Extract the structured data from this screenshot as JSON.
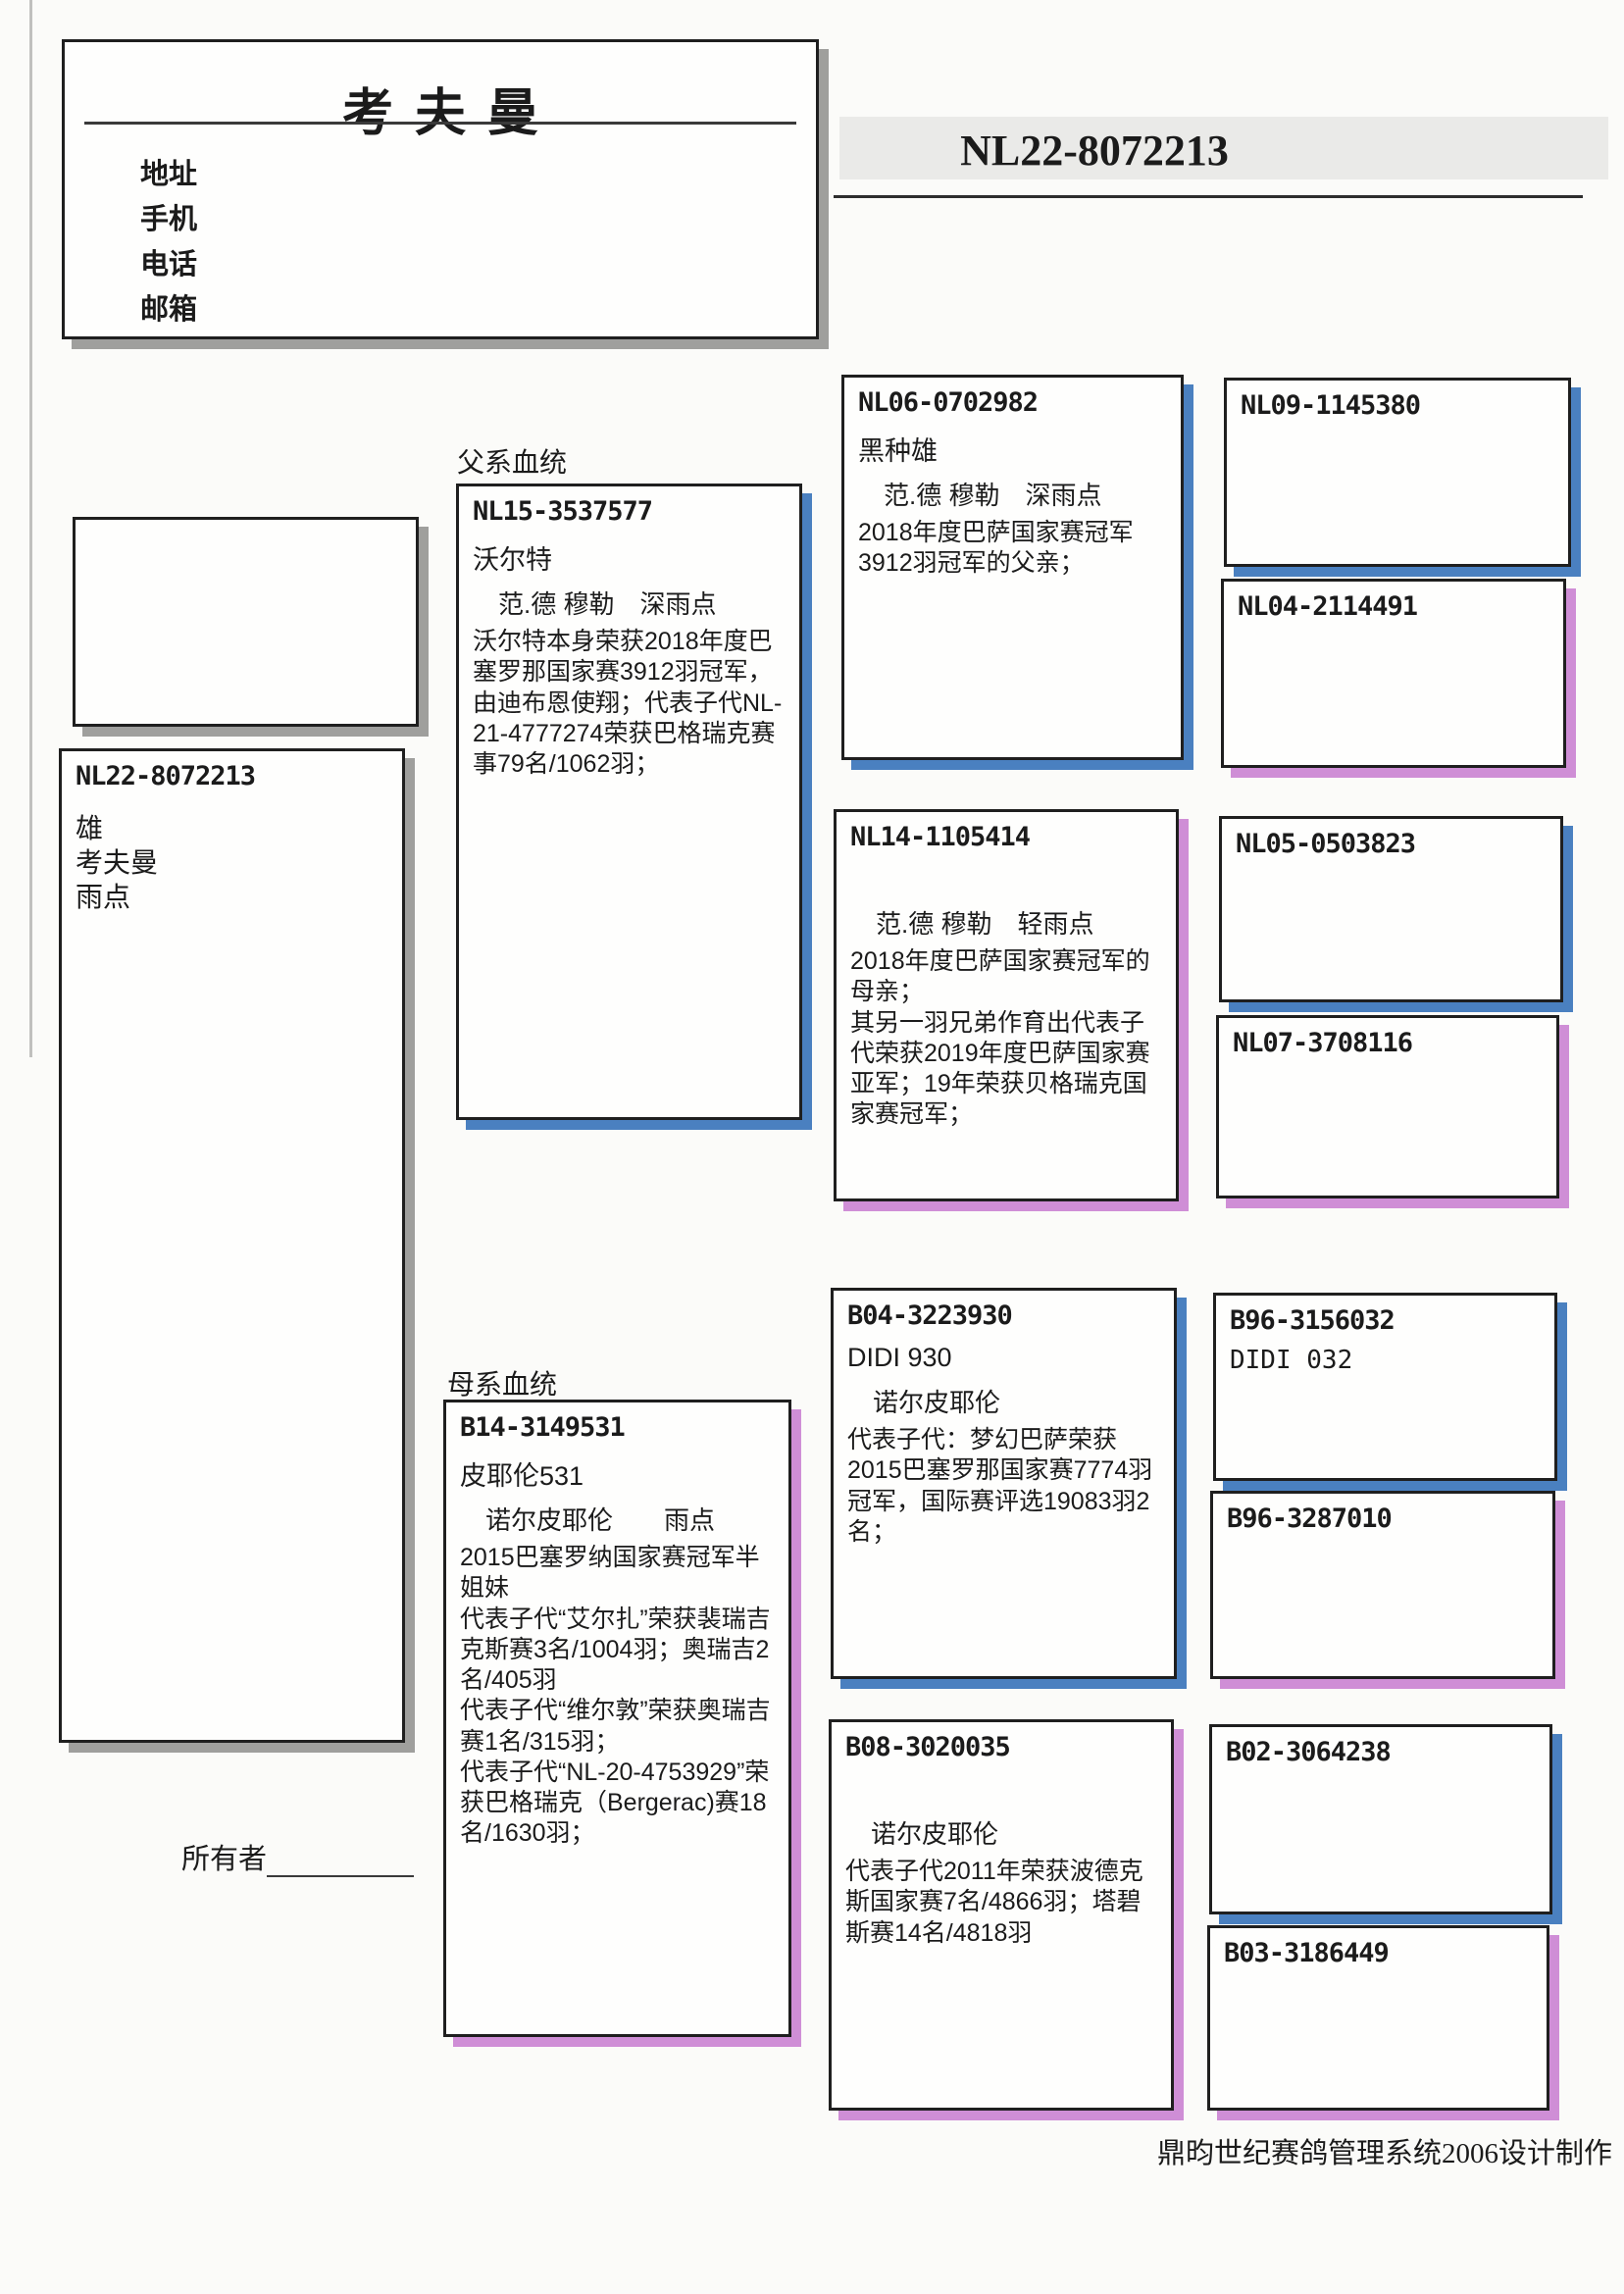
{
  "loft": {
    "title": "考夫曼",
    "labels": [
      "地址",
      "手机",
      "电话",
      "邮箱"
    ]
  },
  "header": {
    "ring": "NL22-8072213"
  },
  "sections": {
    "paternal": "父系血统",
    "maternal": "母系血统"
  },
  "subject": {
    "ring": "NL22-8072213",
    "sex": "雄",
    "strain": "考夫曼",
    "color": "雨点"
  },
  "father": {
    "ring": "NL15-3537577",
    "name": "沃尔特",
    "strain": "范.德 穆勒　深雨点",
    "desc": "沃尔特本身荣获2018年度巴塞罗那国家赛3912羽冠军，由迪布恩使翔；代表子代NL-21-4777274荣获巴格瑞克赛事79名/1062羽；"
  },
  "mother": {
    "ring": "B14-3149531",
    "name": "皮耶伦531",
    "strain": "诺尔皮耶伦　　雨点",
    "desc": "2015巴塞罗纳国家赛冠军半姐妹\n代表子代“艾尔扎”荣获裴瑞吉克斯赛3名/1004羽；奥瑞吉2名/405羽\n代表子代“维尔敦”荣获奥瑞吉赛1名/315羽；\n代表子代“NL-20-4753929”荣获巴格瑞克（Bergerac)赛18名/1630羽；"
  },
  "ff": {
    "ring": "NL06-0702982",
    "name": "黑种雄",
    "strain": "范.德 穆勒　深雨点",
    "desc": "2018年度巴萨国家赛冠军3912羽冠军的父亲；"
  },
  "fm": {
    "ring": "NL14-1105414",
    "name": "",
    "strain": "范.德 穆勒　轻雨点",
    "desc": "2018年度巴萨国家赛冠军的母亲；\n其另一羽兄弟作育出代表子代荣获2019年度巴萨国家赛亚军；19年荣获贝格瑞克国家赛冠军；"
  },
  "mf": {
    "ring": "B04-3223930",
    "name": "DIDI 930",
    "strain": "诺尔皮耶伦",
    "desc": "代表子代：梦幻巴萨荣获2015巴塞罗那国家赛7774羽冠军，国际赛评选19083羽2名；"
  },
  "mm": {
    "ring": "B08-3020035",
    "name": "",
    "strain": "诺尔皮耶伦",
    "desc": "代表子代2011年荣获波德克斯国家赛7名/4866羽；塔碧斯赛14名/4818羽"
  },
  "gg": [
    {
      "ring": "NL09-1145380",
      "name": ""
    },
    {
      "ring": "NL04-2114491",
      "name": ""
    },
    {
      "ring": "NL05-0503823",
      "name": ""
    },
    {
      "ring": "NL07-3708116",
      "name": ""
    },
    {
      "ring": "B96-3156032",
      "name": "DIDI 032"
    },
    {
      "ring": "B96-3287010",
      "name": ""
    },
    {
      "ring": "B02-3064238",
      "name": ""
    },
    {
      "ring": "B03-3186449",
      "name": ""
    }
  ],
  "owner_label": "所有者",
  "footer": "鼎昀世纪赛鸽管理系统2006设计制作",
  "colors": {
    "sire_shadow": "#4a80c0",
    "dam_shadow": "#cf8ed6",
    "neutral_shadow": "#9f9f9d",
    "header_bar": "#eaeae8"
  }
}
